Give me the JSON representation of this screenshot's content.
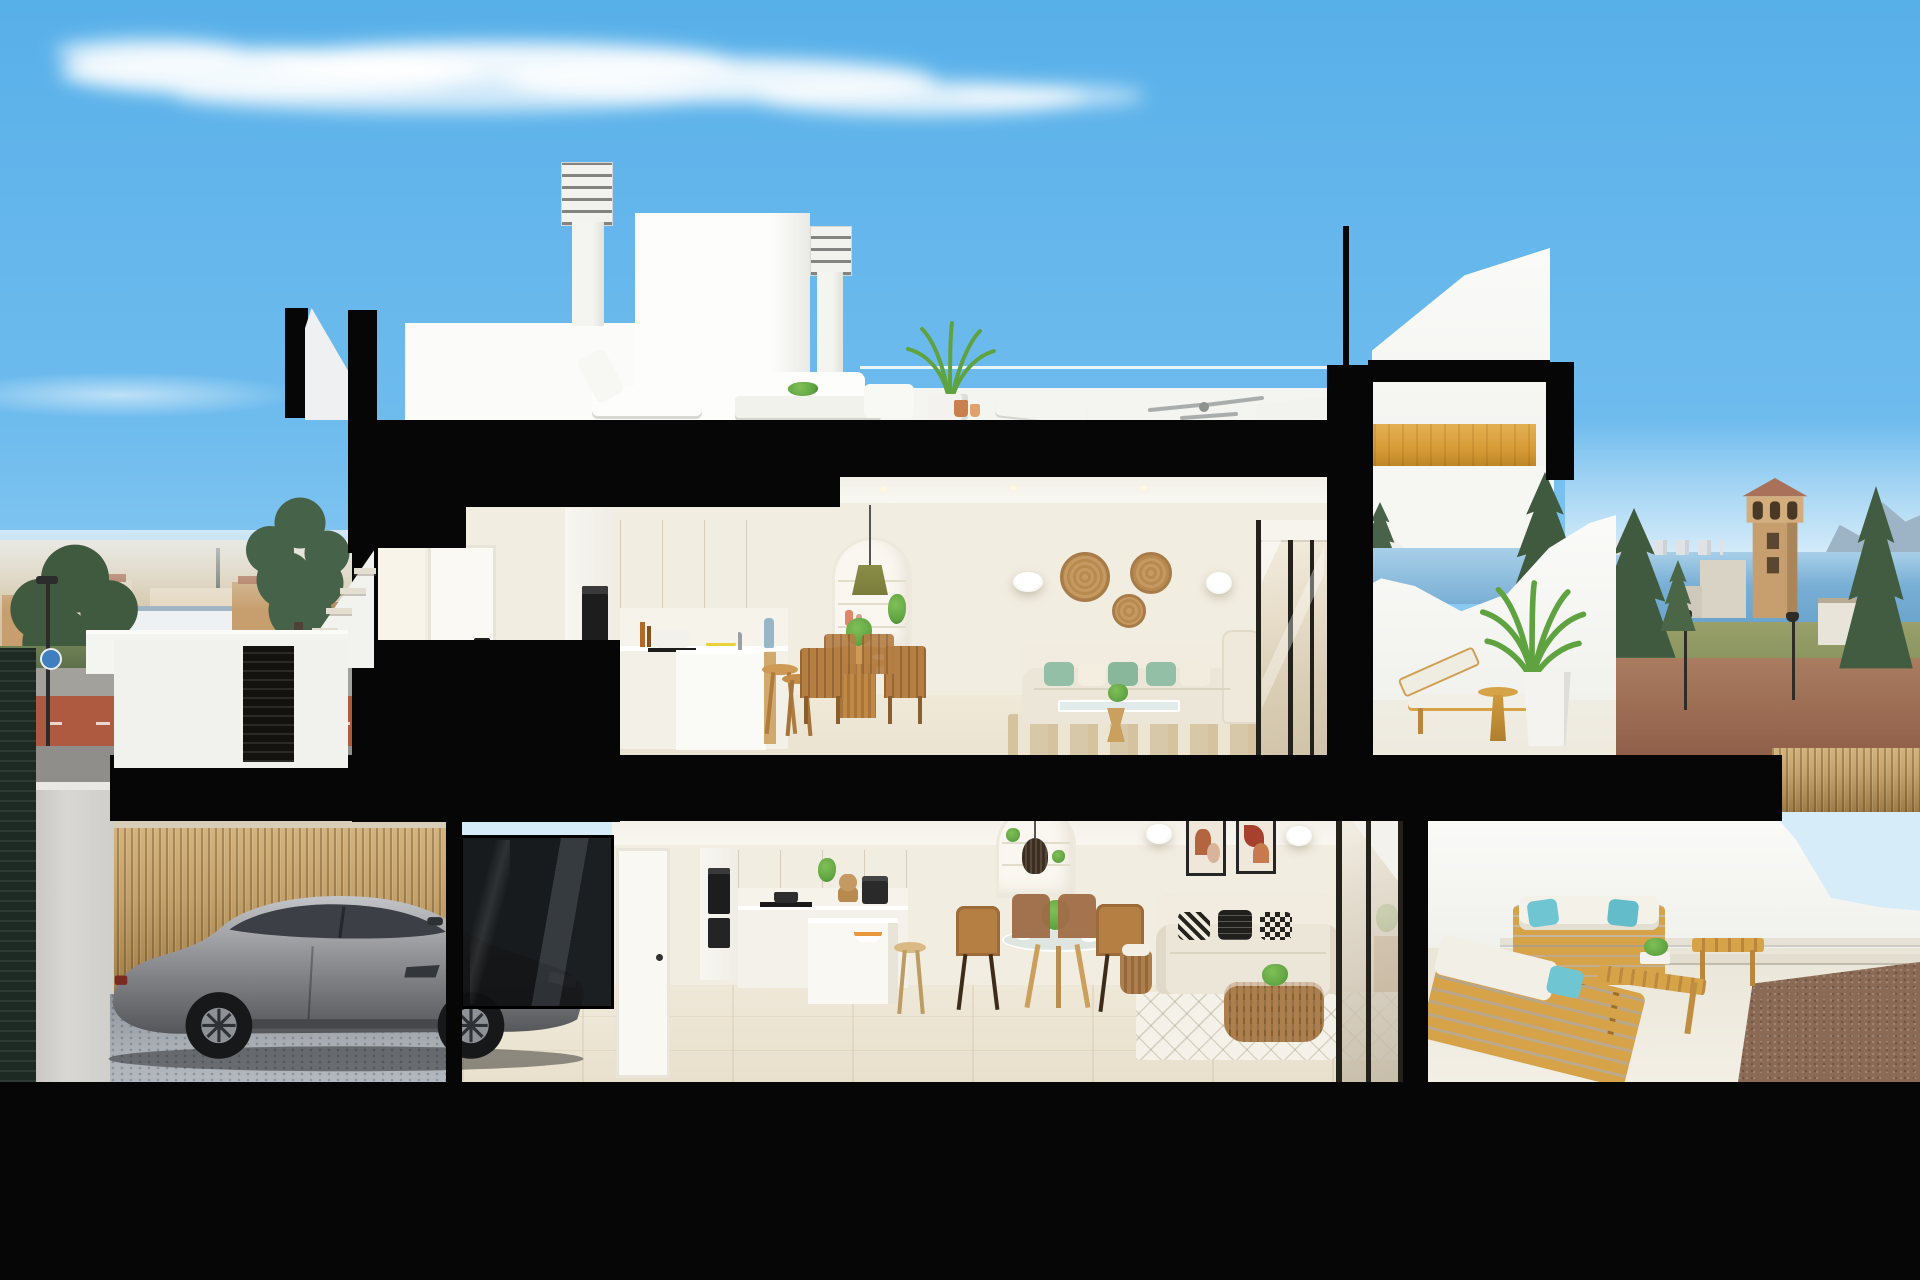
{
  "scene": {
    "title": "3D cross-section render of a two-storey coastal townhouse",
    "setting": "Daytime under a clear blue sky with a wispy cloud; a Mediterranean seaside town, sea, watchtower and mountains in the background",
    "objects": [
      "sky",
      "cloud",
      "town-skyline-left",
      "street-with-bike-lane",
      "street-lamp",
      "round-traffic-sign",
      "sea",
      "distant-skyline",
      "mountains",
      "watchtower",
      "conifer-trees",
      "dirt-road",
      "street-lanterns",
      "roof-terrace",
      "chimney-with-louvers",
      "penthouse-volume",
      "roof-sofa",
      "roof-lounger",
      "roof-palm-plant",
      "ceiling-fan",
      "cut-concrete-slabs",
      "upper-floor-kitchen",
      "kitchen-wood-cabinets",
      "built-in-ovens",
      "kitchen-island",
      "bar-stools",
      "dining-table-wood",
      "dining-chairs",
      "arched-shelf-niche",
      "green-pendant-lamp",
      "wall-sconces",
      "rattan-wall-plates",
      "cream-sofa-green-pillows",
      "coffee-table",
      "jute-rug",
      "sliding-glass-door",
      "upper-terrace",
      "sun-lounger",
      "side-table",
      "potted-areca-palm",
      "golden-wood-staircase",
      "lower-floor-kitchen",
      "coffee-machine",
      "fruit-bowl",
      "glass-dining-table",
      "brown-dining-chairs",
      "framed-abstract-art",
      "sofa-black-white-pillows",
      "rattan-basket-table",
      "diamond-pattern-rug",
      "lower-terrace",
      "outdoor-wood-sofas",
      "teal-outdoor-pillows",
      "outdoor-coffee-table",
      "gravel-bed",
      "stepping-stones",
      "garage",
      "grey-sports-car",
      "bamboo-fence",
      "cobblestone-floor",
      "entry-stairs",
      "louvered-gate",
      "white-entry-door"
    ]
  },
  "colors": {
    "sky-top": "#58b0e9",
    "sky-mid": "#6fbcee",
    "sky-low": "#8ecbf2",
    "sky-horizon": "#d6edf9",
    "cloud": "#ffffff",
    "cut-black": "#060606",
    "wall-white": "#f5f5f1",
    "wall-bright": "#fcfcfa",
    "wall-shadow": "#e4e4df",
    "interior-cream": "#f2ede1",
    "interior-warm": "#f8f4ea",
    "floor-upper": "#ebe3d1",
    "floor-lower": "#e8e0cc",
    "floor-terrace": "#eeeade",
    "wood-cabinet": "#e2c491",
    "wood-cabinet-dark": "#cfa96e",
    "wood-stair": "#d59a35",
    "wood-stair-dark": "#b67e22",
    "wood-outdoor": "#d6a348",
    "wood-chair": "#b57e43",
    "wood-table": "#cf9a55",
    "bamboo": "#c4a26b",
    "sofa-cream": "#ece6d8",
    "pillow-green": "#93bfa6",
    "pillow-teal": "#6fc6d2",
    "pillow-dark": "#211f1c",
    "rattan-light": "#c59a62",
    "rattan": "#ad7f4c",
    "car-body": "#8f9195",
    "car-glass": "#3c4046",
    "car-wheel": "#17181a",
    "cobble": "#a8adb4",
    "cobble-dark": "#8e939b",
    "sea": "#79afd5",
    "mountain": "#9db4c6",
    "town-tan": "#c79f6e",
    "town-light": "#e0d3bb",
    "tree-dark": "#3f5a3e",
    "palm-green": "#5fa341",
    "road-gray": "#a3a19c",
    "bike-red": "#ad5a41",
    "road-dirt": "#9a6b52",
    "gravel": "#8a6a55",
    "art-rust": "#b4643f",
    "art-tan": "#d8b49a",
    "oven-black": "#1d1d1d",
    "frame-dark": "#24201a",
    "glass-warm": "#e7ddc9",
    "lamp-green": "#7a7d3a",
    "orange-fruit": "#e8973f",
    "lemon-yellow": "#e8d23c",
    "rug-ivory": "#f4f1e8",
    "rug-jute": "#e6dcc2",
    "sign-blue": "#3f7fc0"
  }
}
